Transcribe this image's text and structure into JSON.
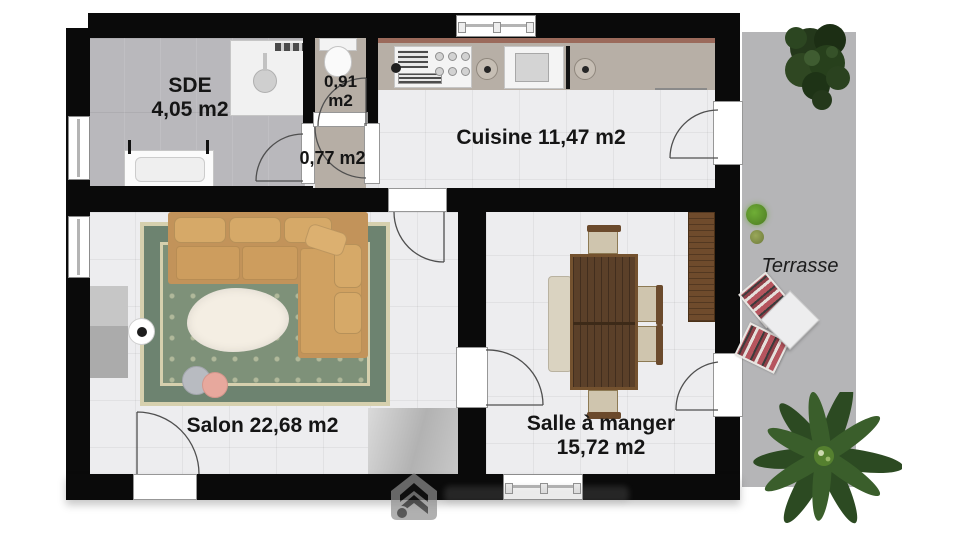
{
  "rooms": {
    "sde": {
      "name": "SDE",
      "area": "4,05 m2"
    },
    "wc": {
      "area_line1": "0,91",
      "area_line2": "m2"
    },
    "hallway": {
      "area": "0,77 m2"
    },
    "cuisine": {
      "label": "Cuisine 11,47 m2"
    },
    "salon": {
      "label": "Salon 22,68 m2"
    },
    "salle_a_manger": {
      "name": "Salle à manger",
      "area": "15,72 m2"
    },
    "terrasse": {
      "label": "Terrasse"
    }
  },
  "colors": {
    "wall": "#0a0a0a",
    "floor_light": "#ededef",
    "floor_sde": "#b9b8bc",
    "floor_wc": "#b6aea5",
    "terrace": "#b5b5b7",
    "counter": "#b7afa6",
    "counter_edge": "#9b6a5b",
    "sofa": "#c2935a",
    "sofa_cushion": "#d6a968",
    "rug_field": "#7e9179",
    "rug_band": "#6d8370",
    "rug_cream": "#d6d0ae",
    "wood_table": "#5b4029",
    "wood_cabinet": "#6f4b2c",
    "bench": "#dad3c1",
    "plant_dark": "#27401c",
    "plant_leaf": "#3a5e2b",
    "plant_bright": "#6fae36",
    "lounger_red": "#b6555e"
  },
  "icons": {
    "shower": "shower-icon",
    "toilet": "toilet-icon",
    "washbasin": "washbasin-icon",
    "stove": "stove-icon",
    "sink": "sink-icon",
    "dishwasher": "dishwasher-icon",
    "plant": "plant-icon",
    "lounge_chair": "lounge-chair-icon",
    "watermark": "house-watermark-icon"
  }
}
